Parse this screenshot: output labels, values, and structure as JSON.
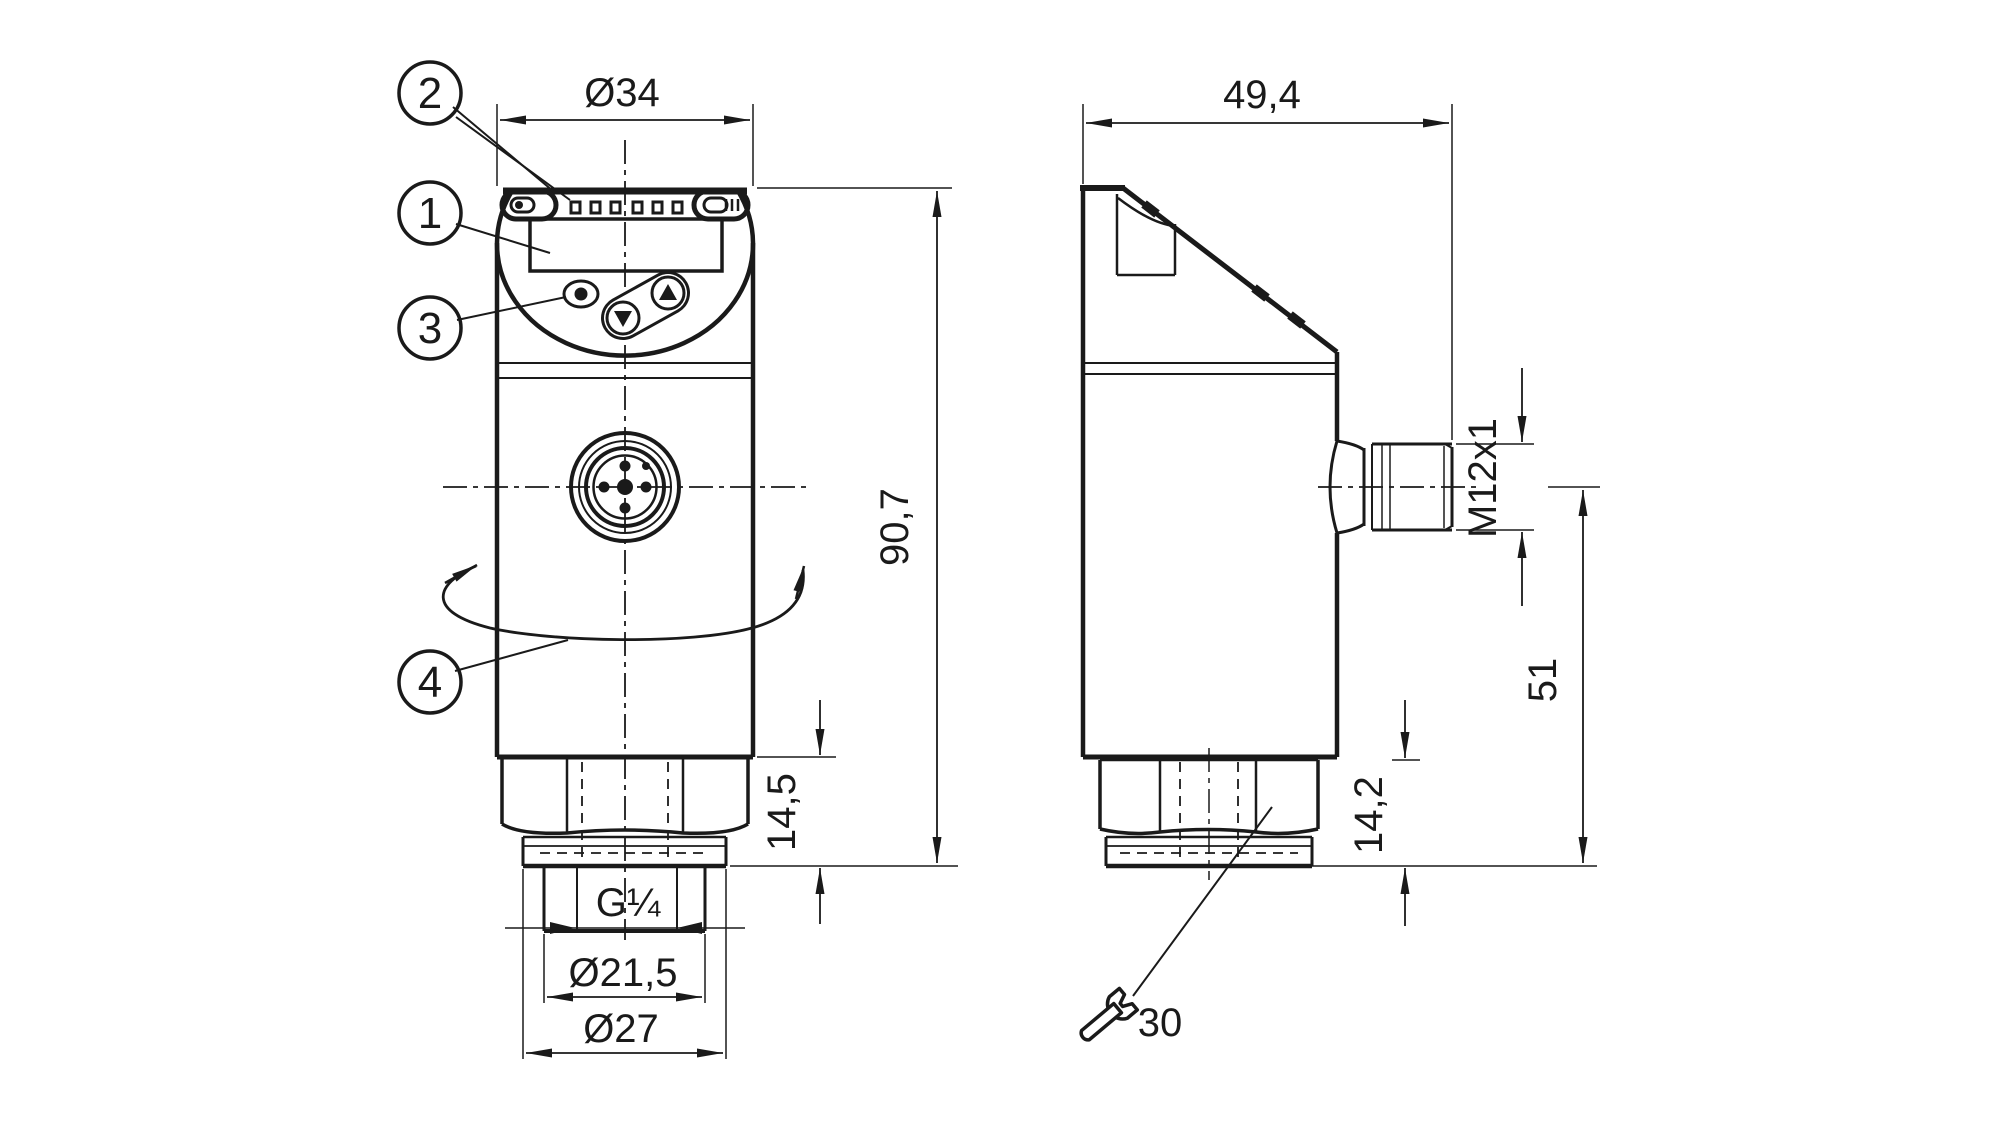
{
  "callouts": {
    "display": "1",
    "leds": "2",
    "buttons": "3",
    "rotation": "4"
  },
  "front_view": {
    "dims": {
      "width": "Ø34",
      "height": "90,7",
      "hex_section_height": "14,5",
      "thread": "G¼",
      "sealing_diameter": "Ø21,5",
      "collar_diameter": "Ø27"
    }
  },
  "side_view": {
    "dims": {
      "depth": "49,4",
      "connector_thread": "M12x1",
      "connector_axis_height": "51",
      "hex_section_height": "14,2",
      "wrench_size": "30"
    }
  },
  "colors": {
    "line": "#1a1a1a",
    "background": "#ffffff"
  }
}
